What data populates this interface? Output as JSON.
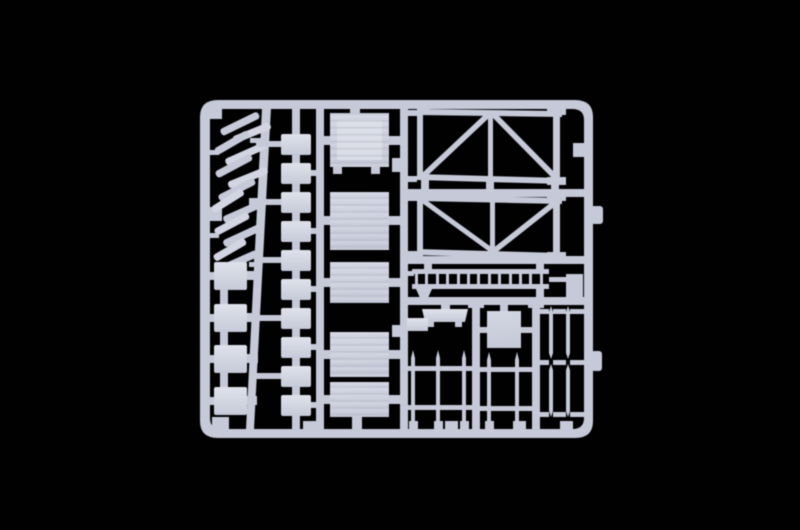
{
  "scene": {
    "type": "product-photograph",
    "subject": "light grey plastic model-kit sprue (parts frame) centered on a black background",
    "background": "#010102",
    "colors": {
      "plastic_base": "#c6cad8",
      "plastic_mid": "#d3d6e2",
      "plastic_light": "#dfe2ea",
      "plastic_dark": "#9ba1b2",
      "texture_line": "#b0b5c4"
    },
    "sprue": {
      "shape": "rounded-rectangle frame with internal runners",
      "part_groups": [
        {
          "name": "plank-stack",
          "description": "pile of small diagonal planks, top left",
          "count": 13
        },
        {
          "name": "small-boxes",
          "description": "square boxes on left rail",
          "count": 4
        },
        {
          "name": "small-blocks",
          "description": "vertical chain of small rectangular blocks",
          "count": 10
        },
        {
          "name": "planked-panels",
          "description": "large rectangular planked panels / crate lids",
          "count": 5
        },
        {
          "name": "truss-girders",
          "description": "large braced truss frames, top right",
          "count": 2
        },
        {
          "name": "ladder",
          "description": "horizontal ladder strip",
          "rungs": 13
        },
        {
          "name": "square-plate",
          "count": 1
        },
        {
          "name": "workbench",
          "count": 1
        },
        {
          "name": "pointed-rods",
          "description": "thin stakes with tapered tips, bottom right",
          "count": 9
        }
      ]
    }
  }
}
